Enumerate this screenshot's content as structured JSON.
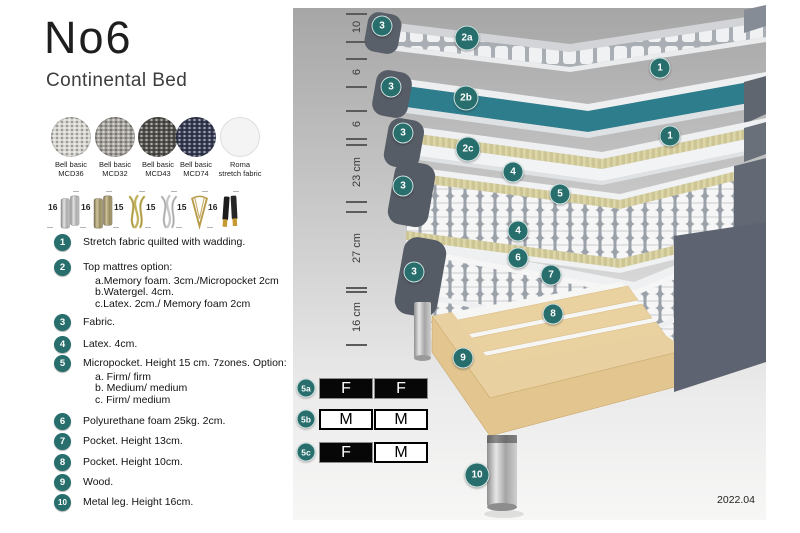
{
  "header": {
    "title": "No6",
    "subtitle": "Continental Bed"
  },
  "swatches": [
    {
      "label1": "Bell basic",
      "label2": "MCD36",
      "color": "#d8d6d0",
      "texture": "woven"
    },
    {
      "label1": "Bell basic",
      "label2": "MCD32",
      "color": "#a5a29c",
      "texture": "woven"
    },
    {
      "label1": "Bell basic",
      "label2": "MCD43",
      "color": "#54524d",
      "texture": "woven"
    },
    {
      "label1": "Bell basic",
      "label2": "MCD74",
      "color": "#363c54",
      "texture": "woven"
    },
    {
      "label1": "Roma",
      "label2": "stretch fabric",
      "color": "#f4f4f4",
      "texture": "plain"
    }
  ],
  "legs": [
    {
      "size": "16",
      "type": "cylinder-silver"
    },
    {
      "size": "16",
      "type": "cylinder-brass"
    },
    {
      "size": "15",
      "type": "twisted-gold"
    },
    {
      "size": "15",
      "type": "twisted-silver"
    },
    {
      "size": "15",
      "type": "hairpin-gold"
    },
    {
      "size": "16",
      "type": "cone-black-gold"
    }
  ],
  "legend": [
    {
      "num": "1",
      "text": "Stretch fabric quilted with wadding."
    },
    {
      "num": "2",
      "text": "Top mattres option:",
      "sub": [
        "a.Memory foam. 3cm./Micropocket 2cm",
        "b.Watergel. 4cm.",
        "c.Latex. 2cm./ Memory foam 2cm"
      ]
    },
    {
      "num": "3",
      "text": "Fabric."
    },
    {
      "num": "4",
      "text": "Latex. 4cm."
    },
    {
      "num": "5",
      "text": "Micropocket. Height 15 cm. 7zones. Option:",
      "sub": [
        "a. Firm/ firm",
        "b. Medium/ medium",
        "c. Firm/ medium"
      ]
    },
    {
      "num": "6",
      "text": "Polyurethane foam 25kg. 2cm."
    },
    {
      "num": "7",
      "text": "Pocket. Height 13cm."
    },
    {
      "num": "8",
      "text": "Pocket. Height 10cm."
    },
    {
      "num": "9",
      "text": "Wood."
    },
    {
      "num": "10",
      "text": "Metal leg. Height 16cm."
    }
  ],
  "diagram": {
    "badges": [
      {
        "label": "3",
        "x": 382,
        "y": 26
      },
      {
        "label": "2a",
        "x": 467,
        "y": 38
      },
      {
        "label": "1",
        "x": 660,
        "y": 68
      },
      {
        "label": "3",
        "x": 391,
        "y": 87
      },
      {
        "label": "2b",
        "x": 466,
        "y": 98
      },
      {
        "label": "1",
        "x": 670,
        "y": 136
      },
      {
        "label": "3",
        "x": 403,
        "y": 133
      },
      {
        "label": "2c",
        "x": 468,
        "y": 149
      },
      {
        "label": "4",
        "x": 513,
        "y": 172
      },
      {
        "label": "3",
        "x": 403,
        "y": 186
      },
      {
        "label": "5",
        "x": 560,
        "y": 194
      },
      {
        "label": "4",
        "x": 518,
        "y": 231
      },
      {
        "label": "6",
        "x": 518,
        "y": 258
      },
      {
        "label": "3",
        "x": 414,
        "y": 272
      },
      {
        "label": "7",
        "x": 551,
        "y": 275
      },
      {
        "label": "8",
        "x": 553,
        "y": 314
      },
      {
        "label": "9",
        "x": 463,
        "y": 358
      },
      {
        "label": "10",
        "x": 477,
        "y": 475
      }
    ],
    "dims": [
      {
        "label": "10",
        "center_y": 27,
        "tick_top": 13,
        "tick_bottom": 41
      },
      {
        "label": "6",
        "center_y": 72,
        "tick_top": 58,
        "tick_bottom": 86
      },
      {
        "label": "6",
        "center_y": 124,
        "tick_top": 110,
        "tick_bottom": 138
      },
      {
        "label": "23 cm",
        "center_y": 172,
        "tick_top": 144,
        "tick_bottom": 201
      },
      {
        "label": "27 cm",
        "center_y": 248,
        "tick_top": 211,
        "tick_bottom": 287
      },
      {
        "label": "16 cm",
        "center_y": 317,
        "tick_top": 291,
        "tick_bottom": 344
      }
    ],
    "firmness": [
      {
        "id": "5a",
        "cells": [
          {
            "text": "F",
            "variant": "dark"
          },
          {
            "text": "F",
            "variant": "dark"
          }
        ]
      },
      {
        "id": "5b",
        "cells": [
          {
            "text": "M",
            "variant": "light"
          },
          {
            "text": "M",
            "variant": "light"
          }
        ]
      },
      {
        "id": "5c",
        "cells": [
          {
            "text": "F",
            "variant": "dark"
          },
          {
            "text": "M",
            "variant": "light"
          }
        ]
      }
    ],
    "version": "2022.04"
  },
  "colors": {
    "accent_teal": "#276e6c",
    "layer_teal": "#2e7d8d",
    "upholstery_gray": "#5d6370",
    "wood": "#e3c68f"
  }
}
